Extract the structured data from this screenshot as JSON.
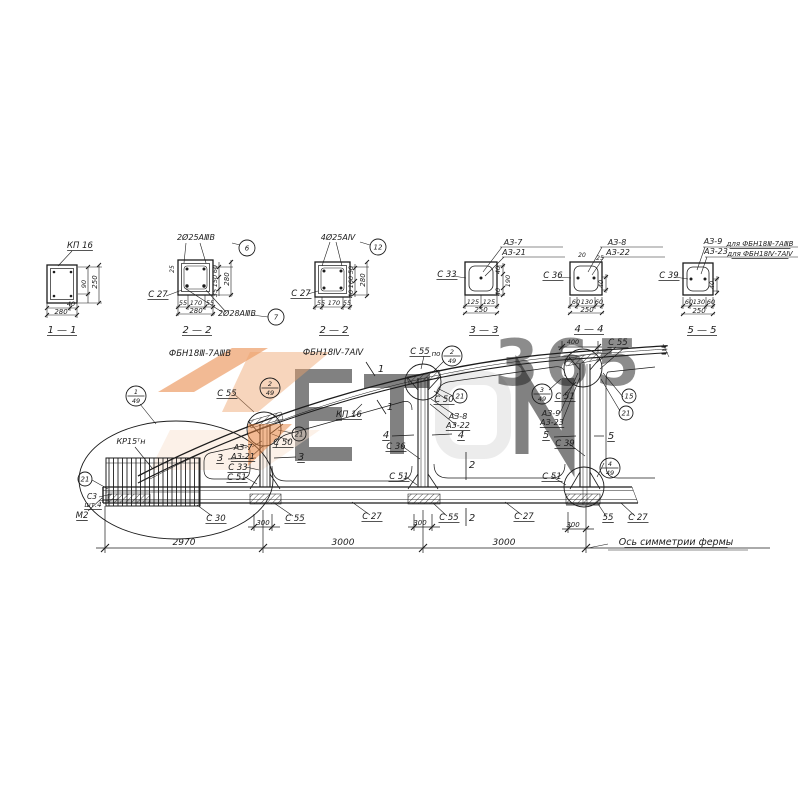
{
  "drawing": {
    "kind": "reinforced-concrete arched truss shop drawing (half elevation + sections)",
    "note_axis": "Ось симметрии фермы",
    "ink": "#1c1c1c",
    "watermark": {
      "text365": "365",
      "letters": "ETON",
      "orange": "#e8813c",
      "gray": "#dedede"
    }
  },
  "section_labels": [
    {
      "x": 80,
      "y": 248,
      "t": "КП 16",
      "ul": 1
    },
    {
      "x": 86,
      "y": 284,
      "t": "90",
      "fs": 6.5,
      "rot": 1
    },
    {
      "x": 97,
      "y": 282,
      "t": "250",
      "fs": 7,
      "rot": 1
    },
    {
      "x": 71,
      "y": 306,
      "t": "40",
      "fs": 6.5
    },
    {
      "x": 61,
      "y": 314,
      "t": "280",
      "fs": 7
    },
    {
      "x": 62,
      "y": 333,
      "t": "1 — 1",
      "fs": 10,
      "ul": 1
    },
    {
      "x": 196,
      "y": 240,
      "t": "2Ø25АⅢВ",
      "fs": 8
    },
    {
      "x": 158,
      "y": 297,
      "t": "С 27",
      "ul": 1
    },
    {
      "x": 237,
      "y": 316,
      "t": "2Ø28АⅢВ",
      "fs": 8
    },
    {
      "x": 183,
      "y": 305,
      "t": "55",
      "fs": 6.5
    },
    {
      "x": 196,
      "y": 305,
      "t": "170",
      "fs": 6.5
    },
    {
      "x": 210,
      "y": 305,
      "t": "55",
      "fs": 6.5
    },
    {
      "x": 196,
      "y": 313,
      "t": "280",
      "fs": 7
    },
    {
      "x": 174,
      "y": 269,
      "t": "25",
      "fs": 6,
      "rot": 1
    },
    {
      "x": 217,
      "y": 269,
      "t": "60",
      "fs": 6.5,
      "rot": 1
    },
    {
      "x": 217,
      "y": 281,
      "t": "150",
      "fs": 6.5,
      "rot": 1
    },
    {
      "x": 217,
      "y": 293,
      "t": "35",
      "fs": 6.5,
      "rot": 1
    },
    {
      "x": 229,
      "y": 279,
      "t": "280",
      "fs": 7,
      "rot": 1
    },
    {
      "x": 197,
      "y": 333,
      "t": "2 — 2",
      "fs": 10,
      "ul": 1
    },
    {
      "x": 200,
      "y": 356,
      "t": "ФБН18Ⅲ-7АⅢВ",
      "fs": 8.5
    },
    {
      "x": 338,
      "y": 240,
      "t": "4Ø25АⅣ",
      "fs": 8
    },
    {
      "x": 301,
      "y": 296,
      "t": "С 27",
      "ul": 1
    },
    {
      "x": 321,
      "y": 305,
      "t": "55",
      "fs": 6.5
    },
    {
      "x": 334,
      "y": 305,
      "t": "170",
      "fs": 6.5
    },
    {
      "x": 347,
      "y": 305,
      "t": "55",
      "fs": 6.5
    },
    {
      "x": 353,
      "y": 270,
      "t": "50",
      "fs": 6.5,
      "rot": 1
    },
    {
      "x": 353,
      "y": 282,
      "t": "160",
      "fs": 6.5,
      "rot": 1
    },
    {
      "x": 353,
      "y": 294,
      "t": "40",
      "fs": 6.5,
      "rot": 1
    },
    {
      "x": 365,
      "y": 280,
      "t": "280",
      "fs": 7,
      "rot": 1
    },
    {
      "x": 334,
      "y": 333,
      "t": "2 — 2",
      "fs": 10,
      "ul": 1
    },
    {
      "x": 333,
      "y": 355,
      "t": "ФБН18Ⅳ-7АⅣ",
      "fs": 8.5
    },
    {
      "x": 513,
      "y": 245,
      "t": "АЗ-7",
      "fs": 8
    },
    {
      "x": 514,
      "y": 255,
      "t": "АЗ-21",
      "fs": 8
    },
    {
      "x": 447,
      "y": 277,
      "t": "С 33",
      "ul": 1
    },
    {
      "x": 473,
      "y": 304,
      "t": "125",
      "fs": 6.5
    },
    {
      "x": 489,
      "y": 304,
      "t": "125",
      "fs": 6.5
    },
    {
      "x": 481,
      "y": 312,
      "t": "250",
      "fs": 7
    },
    {
      "x": 500,
      "y": 270,
      "t": "40",
      "fs": 6.5,
      "rot": 1
    },
    {
      "x": 500,
      "y": 292,
      "t": "40",
      "fs": 6.5,
      "rot": 1
    },
    {
      "x": 510,
      "y": 281,
      "t": "190",
      "fs": 6.5,
      "rot": 1
    },
    {
      "x": 484,
      "y": 333,
      "t": "3 — 3",
      "fs": 10,
      "ul": 1
    },
    {
      "x": 617,
      "y": 245,
      "t": "АЗ-8",
      "fs": 8
    },
    {
      "x": 618,
      "y": 255,
      "t": "АЗ-22",
      "fs": 8
    },
    {
      "x": 582,
      "y": 257,
      "t": "20",
      "fs": 6
    },
    {
      "x": 600,
      "y": 260,
      "t": "25",
      "fs": 6
    },
    {
      "x": 553,
      "y": 278,
      "t": "С 36",
      "ul": 1
    },
    {
      "x": 576,
      "y": 304,
      "t": "60",
      "fs": 6.5
    },
    {
      "x": 587,
      "y": 304,
      "t": "130",
      "fs": 6.5
    },
    {
      "x": 599,
      "y": 304,
      "t": "60",
      "fs": 6.5
    },
    {
      "x": 587,
      "y": 312,
      "t": "250",
      "fs": 7
    },
    {
      "x": 603,
      "y": 284,
      "t": "40",
      "fs": 6.5,
      "rot": 1
    },
    {
      "x": 589,
      "y": 332,
      "t": "4 — 4",
      "fs": 10,
      "ul": 1
    },
    {
      "x": 713,
      "y": 244,
      "t": "АЗ-9",
      "fs": 8
    },
    {
      "x": 760,
      "y": 246,
      "t": "для ФБН18Ⅲ-7АⅢВ",
      "fs": 7,
      "ul": 1
    },
    {
      "x": 716,
      "y": 254,
      "t": "АЗ-23",
      "fs": 8
    },
    {
      "x": 760,
      "y": 256,
      "t": "для ФБН18Ⅳ-7АⅣ",
      "fs": 7,
      "ul": 1
    },
    {
      "x": 669,
      "y": 278,
      "t": "С 39",
      "ul": 1
    },
    {
      "x": 689,
      "y": 304,
      "t": "60",
      "fs": 6.5
    },
    {
      "x": 699,
      "y": 304,
      "t": "130",
      "fs": 6.5
    },
    {
      "x": 711,
      "y": 304,
      "t": "60",
      "fs": 6.5
    },
    {
      "x": 699,
      "y": 313,
      "t": "250",
      "fs": 7
    },
    {
      "x": 714,
      "y": 285,
      "t": "40",
      "fs": 6.5,
      "rot": 1
    },
    {
      "x": 702,
      "y": 333,
      "t": "5 — 5",
      "fs": 10,
      "ul": 1
    }
  ],
  "elevation_labels": [
    {
      "x": 131,
      "y": 444,
      "t": "КР15ᵀн",
      "fs": 8
    },
    {
      "x": 227,
      "y": 396,
      "t": "С 55",
      "ul": 1
    },
    {
      "x": 283,
      "y": 445,
      "t": "С 50",
      "ul": 1
    },
    {
      "x": 243,
      "y": 450,
      "t": "АЗ-7",
      "fs": 8
    },
    {
      "x": 243,
      "y": 459,
      "t": "АЗ-21",
      "fs": 8,
      "ul": 1
    },
    {
      "x": 220,
      "y": 461,
      "t": "3",
      "fs": 10,
      "ul": 1
    },
    {
      "x": 238,
      "y": 470,
      "t": "С 33",
      "ul": 1
    },
    {
      "x": 237,
      "y": 480,
      "t": "С 51",
      "ul": 1
    },
    {
      "x": 301,
      "y": 460,
      "t": "3",
      "fs": 10,
      "ul": 1
    },
    {
      "x": 349,
      "y": 417,
      "t": "КП 16",
      "ul": 1
    },
    {
      "x": 381,
      "y": 372,
      "t": "1",
      "fs": 10
    },
    {
      "x": 390,
      "y": 410,
      "t": "1",
      "fs": 10
    },
    {
      "x": 386,
      "y": 438,
      "t": "4",
      "fs": 10,
      "ul": 1
    },
    {
      "x": 396,
      "y": 449,
      "t": "С 36",
      "ul": 1
    },
    {
      "x": 420,
      "y": 354,
      "t": "С 55",
      "ul": 1
    },
    {
      "x": 436,
      "y": 356,
      "t": "по",
      "fs": 7
    },
    {
      "x": 444,
      "y": 402,
      "t": "С 50",
      "ul": 1
    },
    {
      "x": 458,
      "y": 419,
      "t": "АЗ-8",
      "fs": 8
    },
    {
      "x": 458,
      "y": 428,
      "t": "АЗ-22",
      "fs": 8,
      "ul": 1
    },
    {
      "x": 461,
      "y": 438,
      "t": "4",
      "fs": 10,
      "ul": 1
    },
    {
      "x": 472,
      "y": 468,
      "t": "2",
      "fs": 10
    },
    {
      "x": 472,
      "y": 521,
      "t": "2",
      "fs": 10
    },
    {
      "x": 399,
      "y": 479,
      "t": "С 51",
      "ul": 1
    },
    {
      "x": 552,
      "y": 479,
      "t": "С 51",
      "ul": 1
    },
    {
      "x": 551,
      "y": 416,
      "t": "АЗ-9",
      "fs": 8
    },
    {
      "x": 552,
      "y": 425,
      "t": "АЗ-23",
      "fs": 8,
      "ul": 1
    },
    {
      "x": 546,
      "y": 438,
      "t": "5",
      "fs": 10,
      "ul": 1
    },
    {
      "x": 565,
      "y": 446,
      "t": "С 39",
      "ul": 1
    },
    {
      "x": 565,
      "y": 399,
      "t": "С 51",
      "ul": 1
    },
    {
      "x": 611,
      "y": 439,
      "t": "5",
      "fs": 10,
      "ul": 1
    },
    {
      "x": 618,
      "y": 345,
      "t": "С 55",
      "ul": 1
    },
    {
      "x": 573,
      "y": 344,
      "t": "400",
      "fs": 6.5
    },
    {
      "x": 82,
      "y": 518,
      "t": "М2",
      "ul": 1
    },
    {
      "x": 92,
      "y": 499,
      "t": "С3",
      "fs": 7.5
    },
    {
      "x": 93,
      "y": 507,
      "t": "шт.4",
      "fs": 7,
      "ul": 1
    },
    {
      "x": 216,
      "y": 521,
      "t": "С 30",
      "ul": 1
    },
    {
      "x": 263,
      "y": 525,
      "t": "300",
      "fs": 7
    },
    {
      "x": 295,
      "y": 521,
      "t": "С 55",
      "ul": 1
    },
    {
      "x": 372,
      "y": 519,
      "t": "С 27",
      "ul": 1
    },
    {
      "x": 420,
      "y": 525,
      "t": "300",
      "fs": 7
    },
    {
      "x": 449,
      "y": 520,
      "t": "С 55",
      "ul": 1
    },
    {
      "x": 524,
      "y": 519,
      "t": "С 27",
      "ul": 1
    },
    {
      "x": 573,
      "y": 527,
      "t": "300",
      "fs": 7
    },
    {
      "x": 608,
      "y": 520,
      "t": "55",
      "ul": 1
    },
    {
      "x": 638,
      "y": 520,
      "t": "С 27",
      "ul": 1
    },
    {
      "x": 184,
      "y": 545,
      "t": "2970",
      "fs": 9
    },
    {
      "x": 343,
      "y": 545,
      "t": "3000",
      "fs": 9
    },
    {
      "x": 504,
      "y": 545,
      "t": "3000",
      "fs": 9
    },
    {
      "x": 676,
      "y": 545,
      "t": "Ось симметрии фермы",
      "fs": 9.5,
      "ul": 1
    }
  ],
  "bubbles": [
    {
      "x": 247,
      "y": 248,
      "r": 8,
      "a": "6"
    },
    {
      "x": 276,
      "y": 317,
      "r": 8,
      "a": "7"
    },
    {
      "x": 378,
      "y": 247,
      "r": 8,
      "a": "12"
    },
    {
      "x": 136,
      "y": 396,
      "r": 10,
      "a": "1",
      "b": "49"
    },
    {
      "x": 270,
      "y": 388,
      "r": 10,
      "a": "2",
      "b": "49"
    },
    {
      "x": 452,
      "y": 356,
      "r": 10,
      "a": "2",
      "b": "49"
    },
    {
      "x": 542,
      "y": 394,
      "r": 10,
      "a": "3",
      "b": "49"
    },
    {
      "x": 610,
      "y": 468,
      "r": 10,
      "a": "4",
      "b": "49"
    },
    {
      "x": 85,
      "y": 479,
      "r": 7,
      "a": "21"
    },
    {
      "x": 299,
      "y": 434,
      "r": 7,
      "a": "21"
    },
    {
      "x": 460,
      "y": 396,
      "r": 7,
      "a": "21"
    },
    {
      "x": 629,
      "y": 396,
      "r": 7,
      "a": "15"
    },
    {
      "x": 626,
      "y": 413,
      "r": 7,
      "a": "21"
    }
  ]
}
